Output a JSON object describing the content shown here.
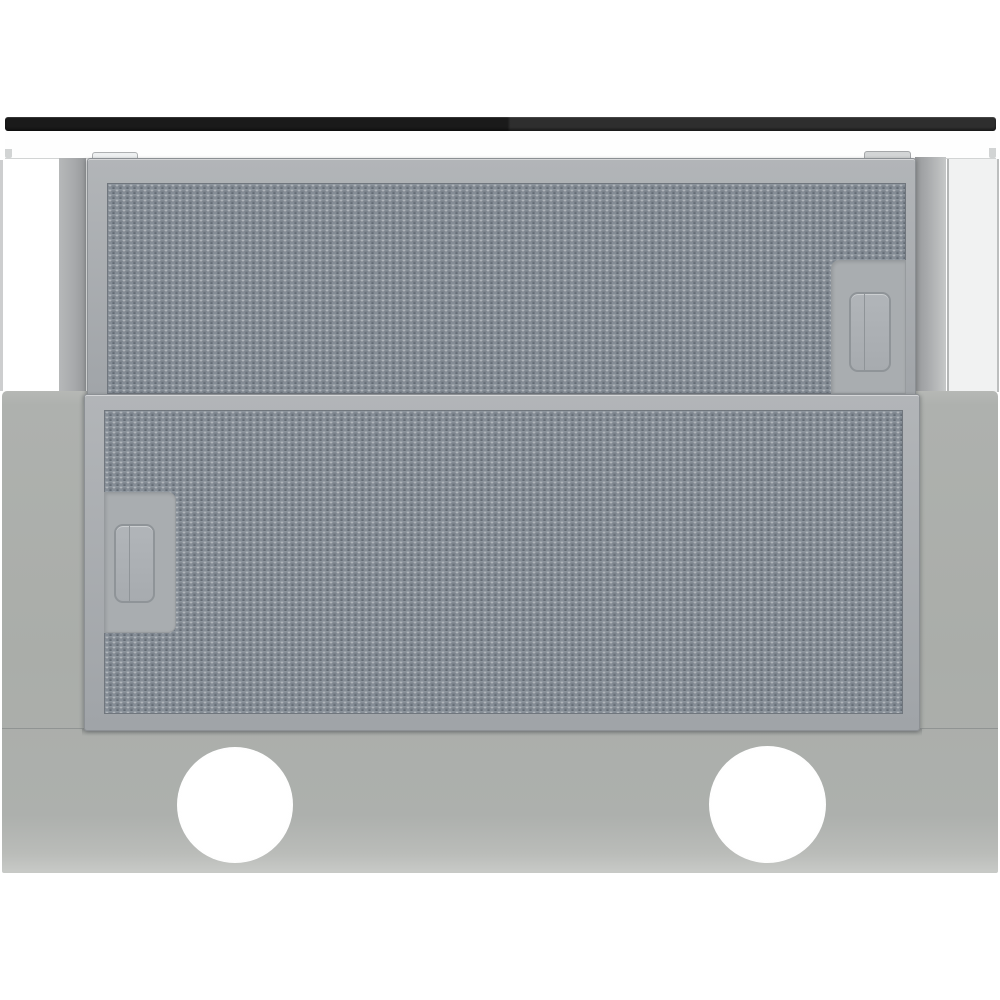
{
  "scene": {
    "type": "product-photo",
    "subject": "Underside of a built-in telescopic cooker hood with two knurled aluminium grease filters, filter pull handles, release latches and two round white lamp openings",
    "text_content": "none — the photograph contains no visible text",
    "filters": {
      "count": 2,
      "texture": "knurled metal mesh",
      "handles": 2,
      "latches": 2
    },
    "lights": {
      "count": 2,
      "shape": "circle",
      "color": "#ffffff"
    },
    "colors": {
      "background": "#ffffff",
      "black_bar_dark": "#1a1a1a",
      "black_bar_light": "#2e2e2e",
      "panel_white": "#fefefe",
      "panel_edge": "#d2d4d4",
      "wall_edge": "#cdcecf",
      "cabinet_band": "#f1f2f2",
      "side_panel": "#a8aaac",
      "side_panel_light": "#c6c8c8",
      "frame_light": "#b2b5b8",
      "frame_dark": "#a0a4a8",
      "frame_border": "#8c9094",
      "recess": "#a9adb0",
      "handle_border": "#8f9498",
      "mesh_base": "#858d96",
      "mesh_highlight": "rgba(255,255,255,.52)",
      "mesh_shadow": "rgba(22,28,36,.44)",
      "body_base": "#aaada9",
      "body_bottom_edge": "#c7c9c6",
      "lamp": "#ffffff"
    }
  }
}
